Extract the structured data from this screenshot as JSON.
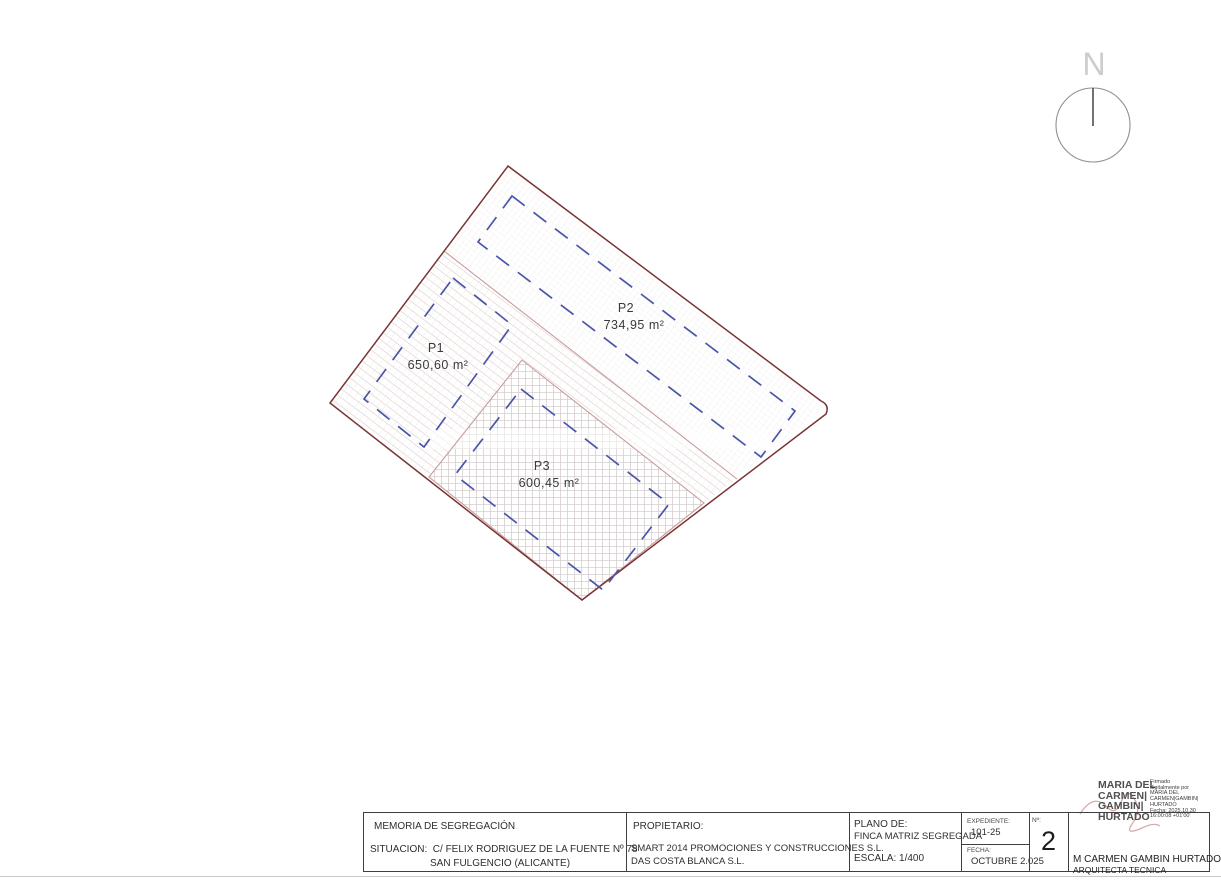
{
  "compass": {
    "label": "N"
  },
  "plan": {
    "parcels": [
      {
        "id": "P1",
        "area": "650,60 m²"
      },
      {
        "id": "P2",
        "area": "734,95 m²"
      },
      {
        "id": "P3",
        "area": "600,45 m²"
      }
    ],
    "colors": {
      "boundary": "#7b3434",
      "division": "#c79c9c",
      "parcel_dash": "#4a55aa"
    }
  },
  "titleblock": {
    "project": {
      "title": "MEMORIA DE SEGREGACIÓN",
      "situacion_label": "SITUACION:",
      "address_line1": "C/ FELIX RODRIGUEZ DE LA FUENTE Nº 78",
      "address_line2": "SAN FULGENCIO (ALICANTE)"
    },
    "owner": {
      "label": "PROPIETARIO:",
      "line1": "SMART 2014 PROMOCIONES Y CONSTRUCCIONES S.L.",
      "line2": "DAS COSTA BLANCA S.L."
    },
    "plano": {
      "label": "PLANO DE:",
      "name": "FINCA MATRIZ SEGREGADA",
      "escala": "ESCALA: 1/400"
    },
    "expediente": {
      "label": "EXPEDIENTE:",
      "value": "101-25",
      "fecha_label": "FECHA:",
      "fecha_value": "OCTUBRE 2.025"
    },
    "sheet": {
      "label": "Nº:",
      "number": "2"
    },
    "author": {
      "name": "M CARMEN GAMBIN HURTADO",
      "title": "ARQUITECTA TECNICA"
    }
  },
  "signature": {
    "name_lines": [
      "MARIA DEL",
      "CARMEN|",
      "GAMBIN|",
      "HURTADO"
    ],
    "detail_lines": [
      "Firmado",
      "digitalmente por",
      "MARIA DEL",
      "CARMEN|GAMBIN|",
      "HURTADO",
      "Fecha: 2025.10.30",
      "16:00:08 +01'00'"
    ]
  }
}
